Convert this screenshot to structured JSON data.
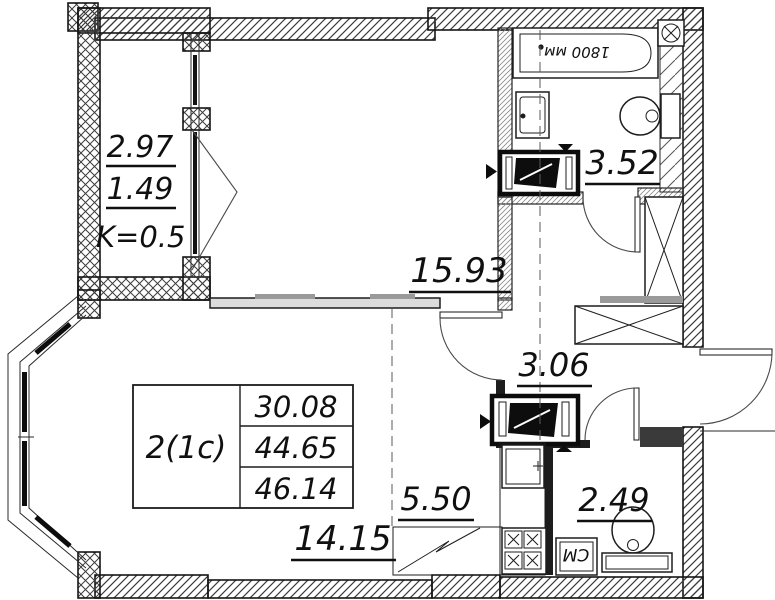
{
  "plan": {
    "info_table": {
      "apartment_type": "2(1c)",
      "living_area": "30.08",
      "total_area": "44.65",
      "total_area_with_coef": "46.14"
    },
    "rooms": {
      "main_room": {
        "area": "15.93"
      },
      "living_zone": {
        "area": "14.15"
      },
      "kitchen_zone": {
        "area": "5.50"
      },
      "hallway": {
        "area": "3.06"
      },
      "bathroom": {
        "area": "3.52",
        "bathtub_length": "1800 мм"
      },
      "wc": {
        "area": "2.49",
        "washing_machine": "СМ"
      },
      "balcony": {
        "area": "2.97",
        "area_with_coef": "1.49",
        "coef_note": "K=0.5"
      }
    }
  }
}
